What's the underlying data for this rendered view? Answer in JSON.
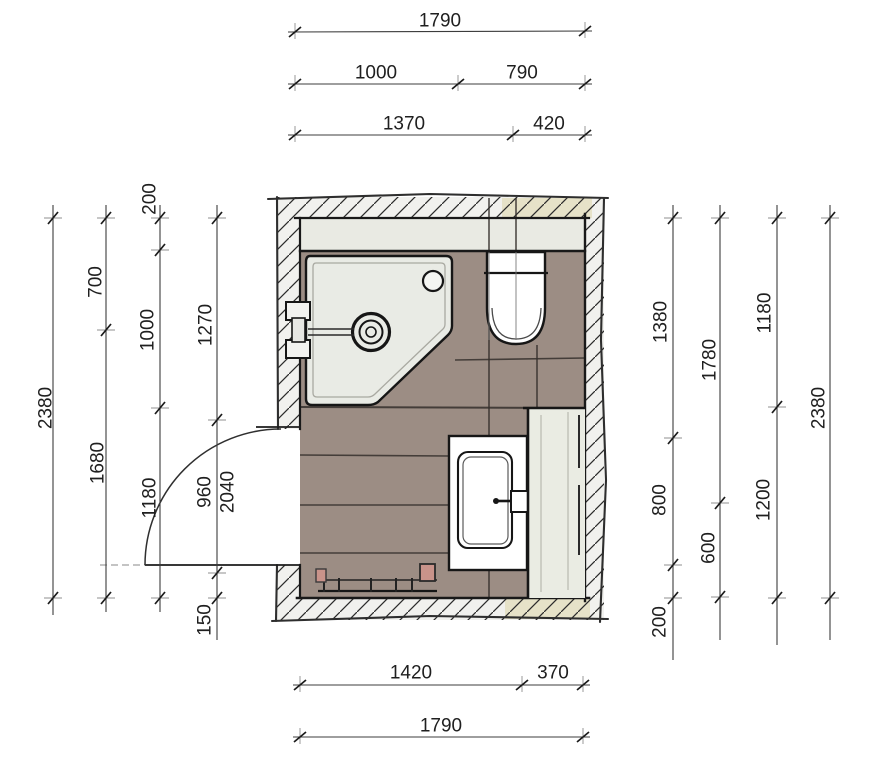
{
  "drawing": {
    "type": "bathroom floor plan sketch",
    "fixtures": [
      "shower-tray",
      "toilet",
      "washbasin-vanity",
      "tall-cabinet",
      "radiator",
      "door-swing"
    ]
  },
  "dimensions": {
    "top_rows": [
      {
        "segments": [
          "1790"
        ]
      },
      {
        "segments": [
          "1000",
          "790"
        ]
      },
      {
        "segments": [
          "1370",
          "420"
        ]
      }
    ],
    "bottom_rows": [
      {
        "segments": [
          "1420",
          "370"
        ]
      },
      {
        "segments": [
          "1790"
        ]
      }
    ],
    "left_columns": [
      {
        "segments": [
          "2380"
        ]
      },
      {
        "segments": [
          "700",
          "1680"
        ]
      },
      {
        "segments": [
          "200",
          "1000",
          "1180"
        ]
      },
      {
        "segments": [
          "1270",
          "960",
          "150"
        ],
        "extra": "2040"
      }
    ],
    "right_columns": [
      {
        "segments": [
          "1380",
          "800",
          "200"
        ]
      },
      {
        "segments": [
          "1780",
          "600"
        ]
      },
      {
        "segments": [
          "1180",
          "1200"
        ]
      },
      {
        "segments": [
          "2380"
        ]
      }
    ]
  },
  "colors": {
    "floor": "#9c8d84",
    "wall_base": "#f1f1ee",
    "inner_band": "#e9eae3",
    "shower_tray": "#e9ebe5",
    "fixture_white": "#ffffff",
    "cabinet": "#eaece3",
    "cream_accent": "#e6e2c8",
    "radiator_accent": "#c9938a"
  }
}
